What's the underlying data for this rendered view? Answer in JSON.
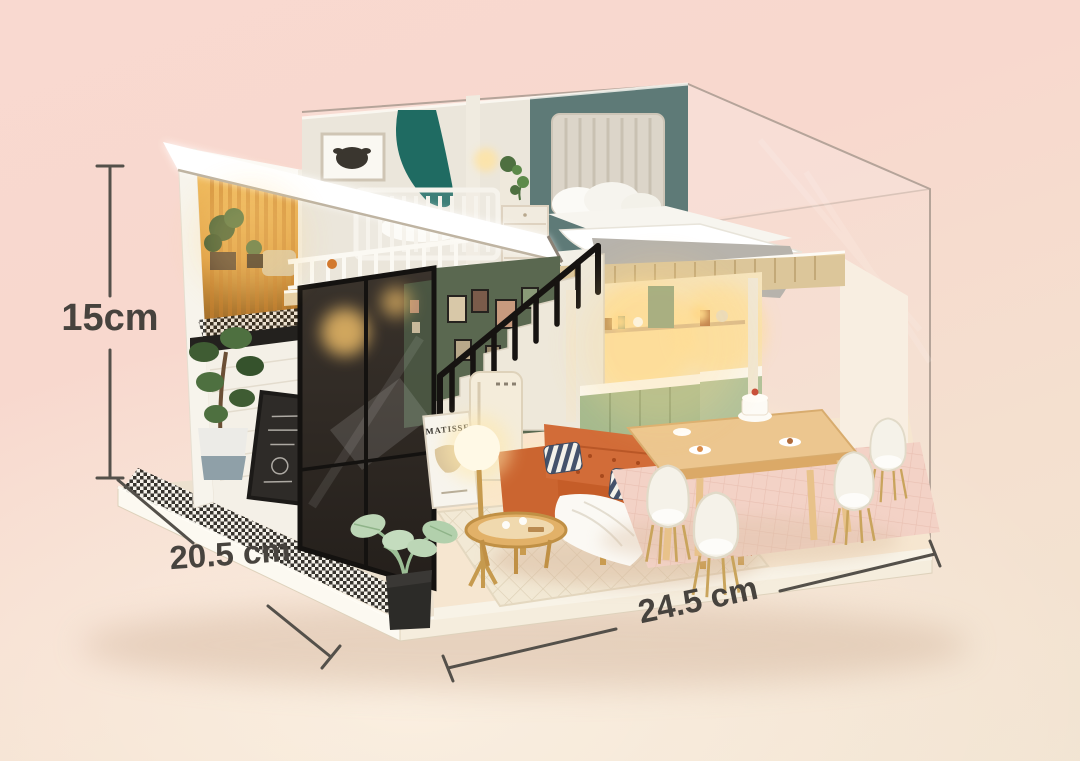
{
  "scene": {
    "type": "product-photo",
    "subject": "DIY miniature two-storey loft dollhouse displayed inside a clear acrylic dust cover on a white base",
    "background_top_color": "#f8d8ce",
    "background_bottom_color": "#f2e4d2"
  },
  "annotations": {
    "height_label": "15cm",
    "depth_label": "20.5 cm",
    "width_label": "24.5 cm",
    "line_color": "#54504a",
    "text_color": "#47433e"
  },
  "poster": {
    "text": "MATISSE"
  },
  "palette": {
    "teal_bedroom_wall": "#5e7a77",
    "gallery_wall_green": "#5a6850",
    "sofa_orange": "#c55d28",
    "cabinet_sage": "#a6ba8e",
    "canopy_teal": "#1f6b62",
    "wood": "#e7d0a6",
    "gold": "#c99b4f",
    "base_cream": "#fcf9f1"
  }
}
